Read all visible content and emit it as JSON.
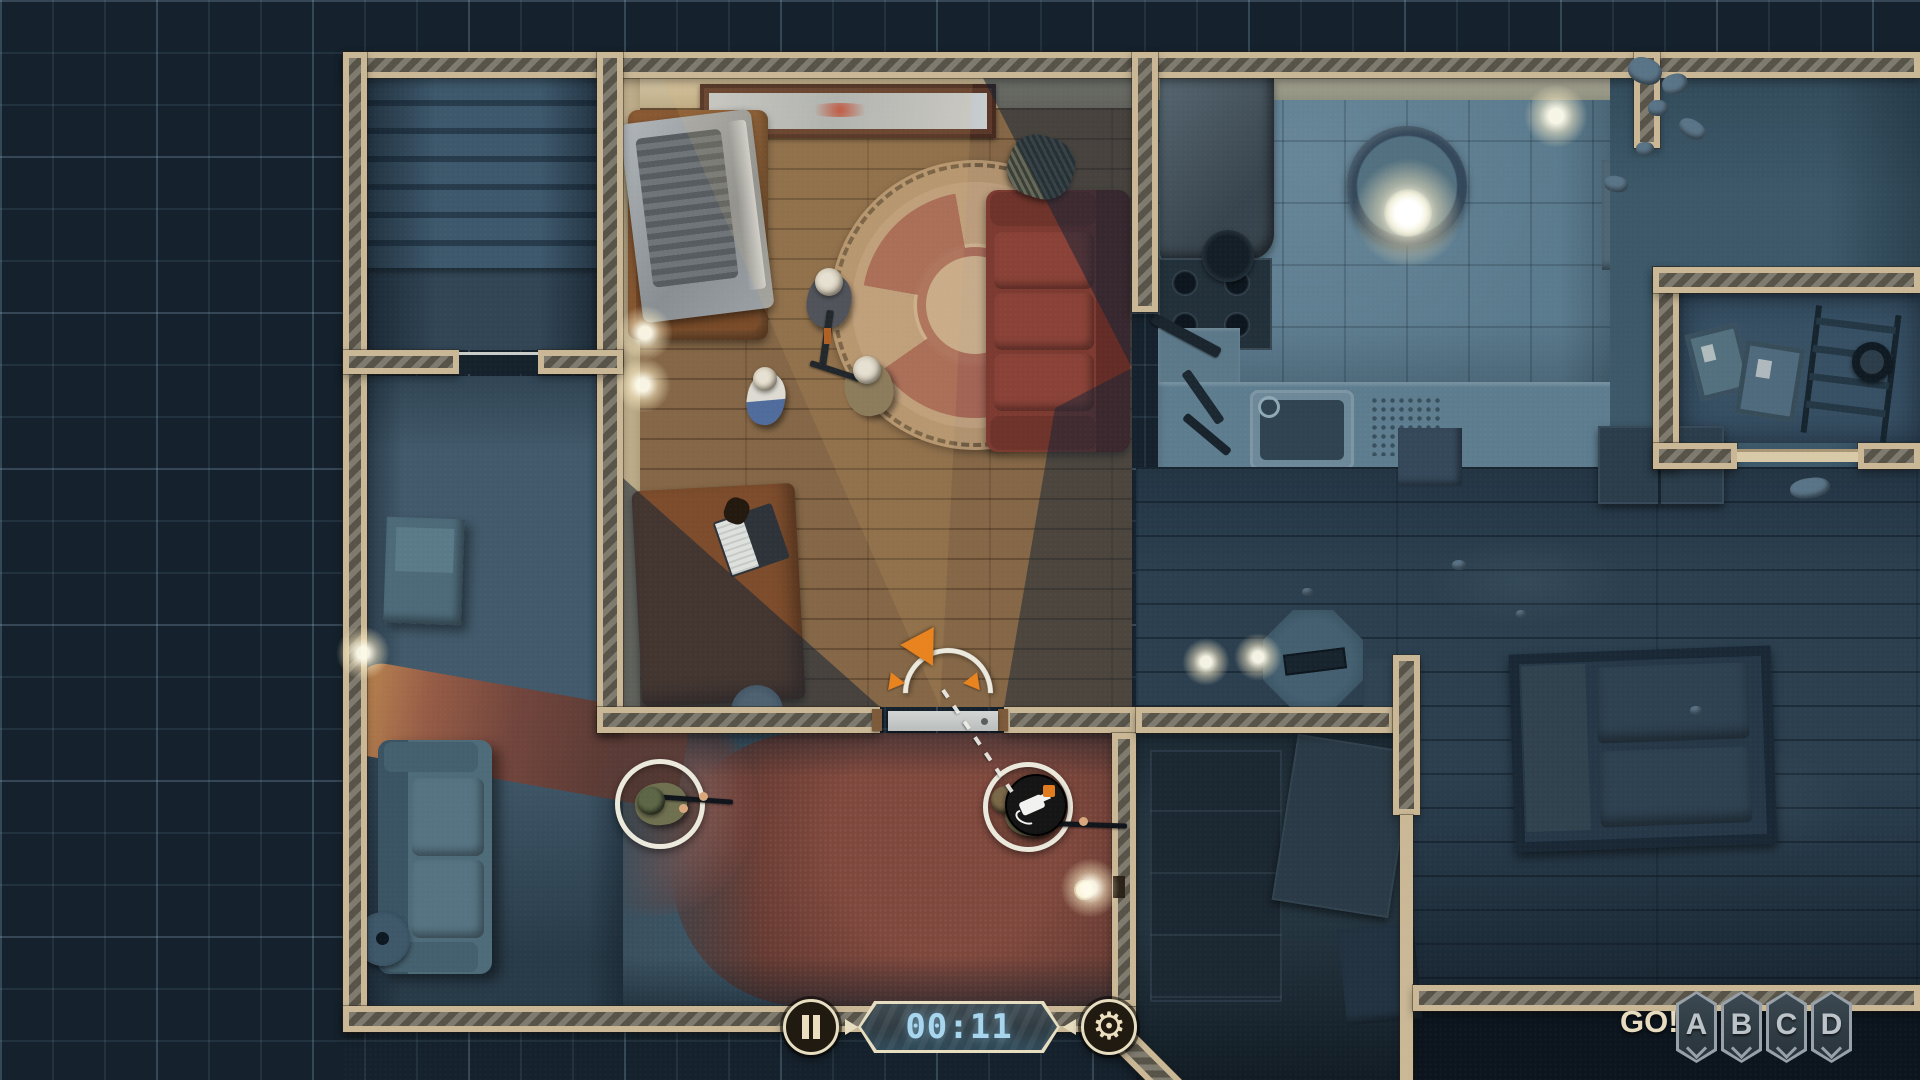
{
  "window": {
    "width": 1920,
    "height": 1080,
    "view": "top-down tactical floorplan with fog of war"
  },
  "hud": {
    "timer": {
      "value": "00:11",
      "pause_icon": "pause-icon",
      "settings_icon": "gear-icon",
      "step_forward_icon": "triangle-right-icon",
      "step_back_icon": "triangle-left-icon"
    },
    "squad_bar": {
      "go_label": "GO!",
      "squads": [
        {
          "label": "A"
        },
        {
          "label": "B"
        },
        {
          "label": "C"
        },
        {
          "label": "D"
        }
      ]
    }
  },
  "scene": {
    "rooms": [
      {
        "name": "staircase",
        "state": "fog"
      },
      {
        "name": "hallway",
        "state": "fog"
      },
      {
        "name": "living-room",
        "state": "visible"
      },
      {
        "name": "kitchen",
        "state": "fog"
      },
      {
        "name": "entry-room",
        "state": "visible"
      },
      {
        "name": "main-hall",
        "state": "fog"
      },
      {
        "name": "storage-room",
        "state": "fog"
      },
      {
        "name": "side-room",
        "state": "fog"
      }
    ],
    "units": [
      {
        "id": "swat-officer-1",
        "type": "swat",
        "x": 660,
        "y": 804,
        "selected": true
      },
      {
        "id": "swat-officer-2",
        "type": "swat",
        "x": 1028,
        "y": 807,
        "selected": true,
        "order_badge": "breach-tool-badge"
      },
      {
        "id": "insurgent-1",
        "type": "insurgent",
        "x": 830,
        "y": 297
      },
      {
        "id": "insurgent-2",
        "type": "insurgent",
        "x": 870,
        "y": 385
      },
      {
        "id": "civilian-1",
        "type": "civilian",
        "x": 766,
        "y": 396
      }
    ],
    "orders": [
      {
        "unit": "swat-officer-2",
        "type": "move-and-breach",
        "target_door": "living-room-south-door",
        "facing_widget": {
          "x": 943,
          "y": 677,
          "arc": "180deg",
          "color": "#e8831e"
        }
      }
    ]
  },
  "colors": {
    "grid_bg": "#15212c",
    "wall_tan": "#c9b795",
    "wall_hatch": "#575349",
    "fog_blue": "#41596a",
    "lit_wood": "#7e6143",
    "carpet_red": "#7a453a",
    "accent_orange": "#e8831e",
    "hud_cream": "#e7ddc1",
    "timer_blue": "#a7d6ee"
  }
}
